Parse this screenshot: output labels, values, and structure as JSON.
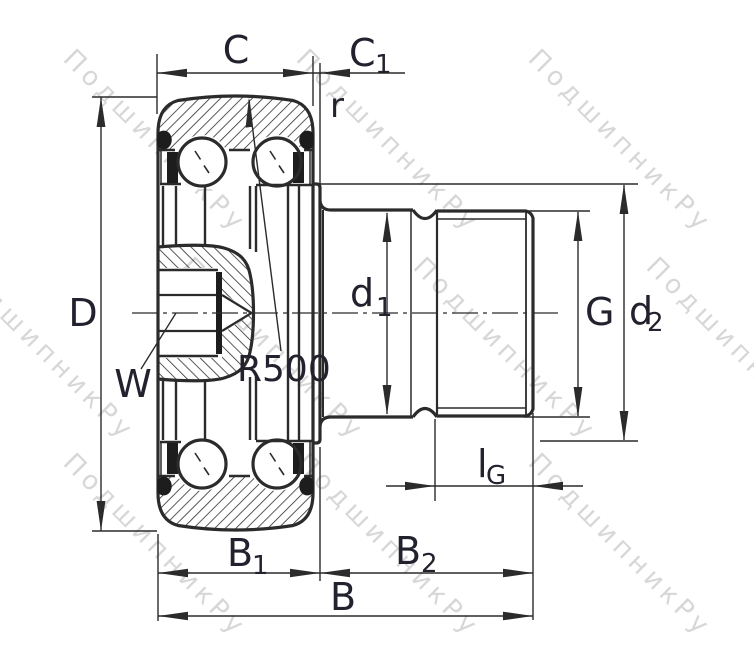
{
  "drawing": {
    "kind": "bearing-cross-section",
    "line_color": "#2b2b2b",
    "label_color": "#22222e",
    "background": "#ffffff"
  },
  "watermark": {
    "text": "ПодшипникРу",
    "color": "#b0b0b0"
  },
  "labels": {
    "C": {
      "text": "C"
    },
    "C1": {
      "main": "C",
      "sub": "1"
    },
    "r": {
      "text": "r"
    },
    "D": {
      "text": "D"
    },
    "W": {
      "text": "W"
    },
    "R500": {
      "text": "R500"
    },
    "d1": {
      "main": "d",
      "sub": "1"
    },
    "G": {
      "text": "G"
    },
    "d2": {
      "main": "d",
      "sub": "2"
    },
    "lG": {
      "main": "l",
      "sub": "G"
    },
    "B1": {
      "main": "B",
      "sub": "1"
    },
    "B2": {
      "main": "B",
      "sub": "2"
    },
    "B": {
      "text": "B"
    }
  }
}
